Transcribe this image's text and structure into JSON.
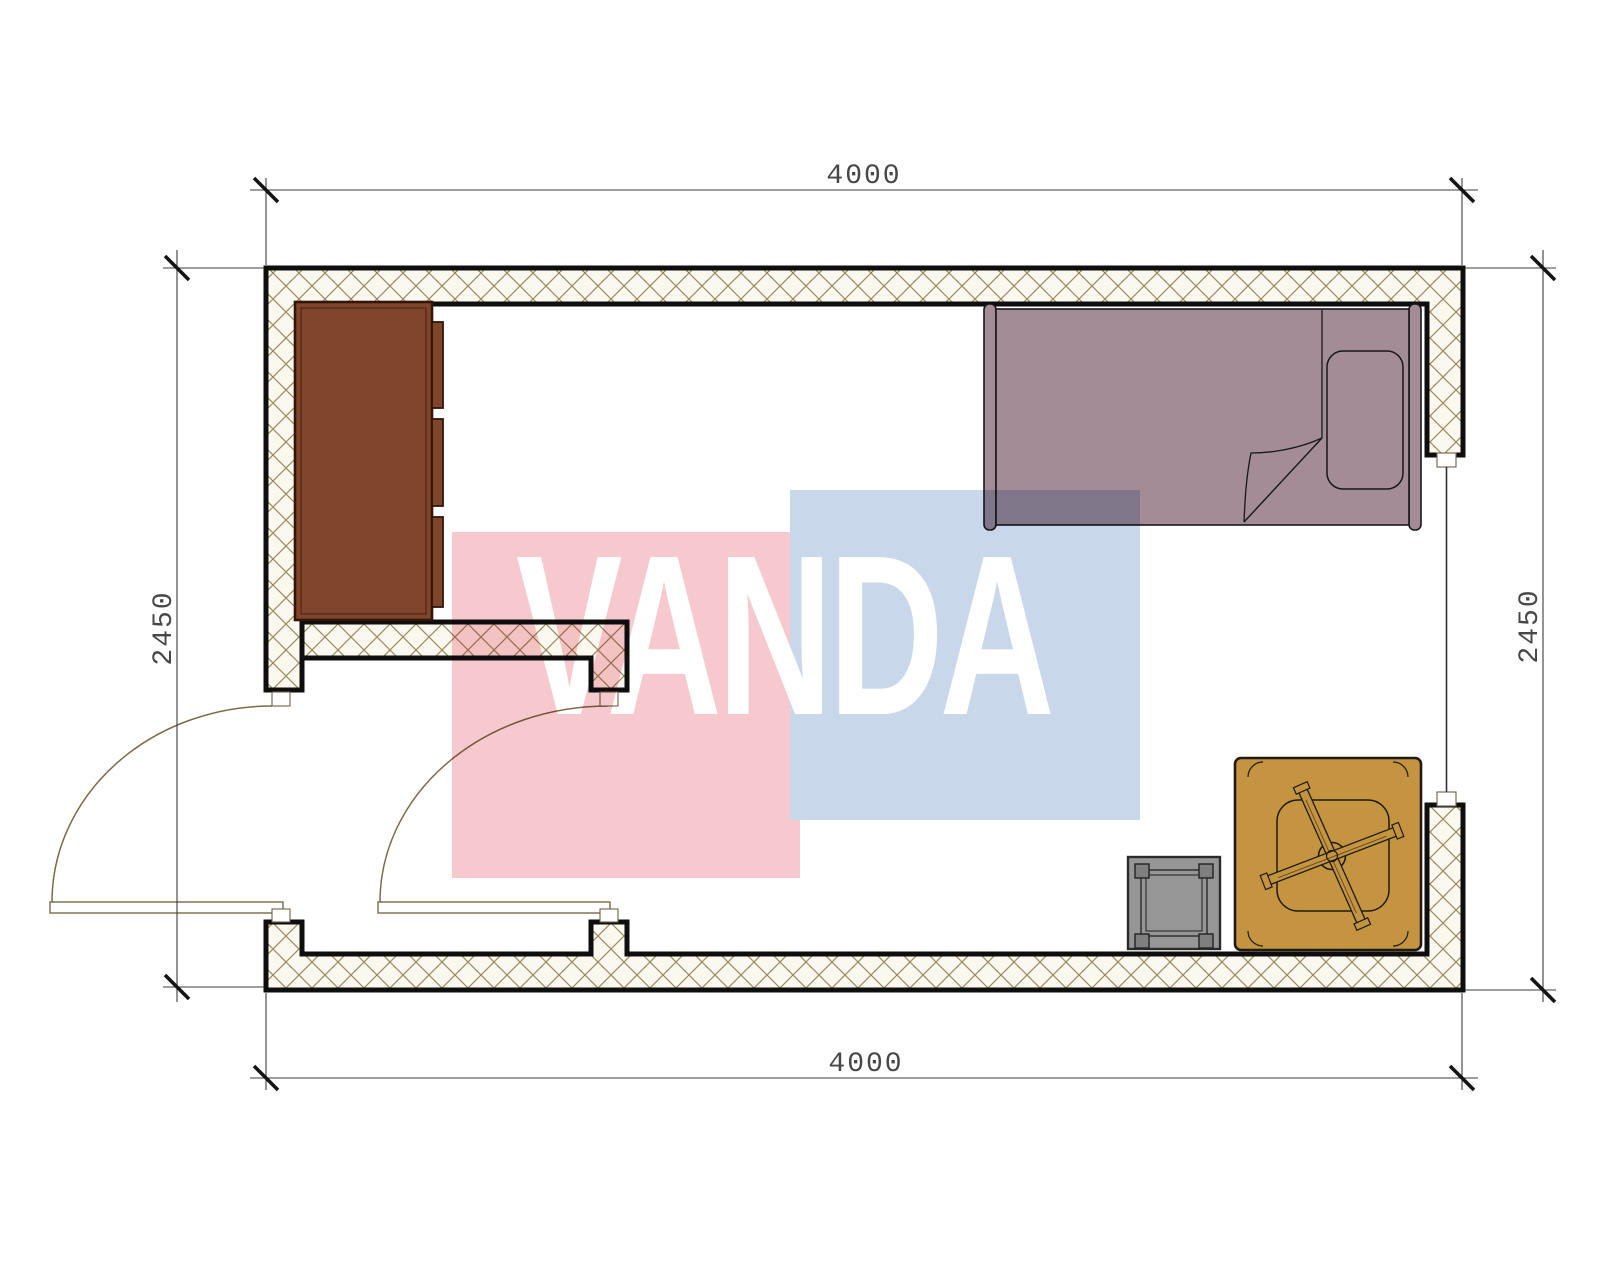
{
  "page": {
    "background": "#ffffff",
    "kind": "architectural floor plan drawing"
  },
  "plan": {
    "room": {
      "width_label": "4000",
      "depth_label": "2450",
      "units": "mm"
    },
    "dimensions": {
      "top": "4000",
      "bottom": "4000",
      "left": "2450",
      "right": "2450"
    },
    "walls": {
      "fill": "#fbf8ef",
      "hatch_line_color": "#9a8a60",
      "outline_color": "#0e0e0e"
    },
    "furniture": {
      "wardrobe": {
        "color": "#80462c",
        "label": "wardrobe cabinet with three door fronts"
      },
      "bed": {
        "color": "#a38c96",
        "label": "single bed with pillow and folded blanket"
      },
      "table": {
        "color": "#c49441",
        "label": "square table with x-shaped leg base"
      },
      "stool": {
        "color": "#969696",
        "leg_color": "#7f7f7f",
        "label": "square stool"
      }
    },
    "doors": {
      "line_color": "#7c6a47",
      "count": 2
    },
    "window": {
      "line_color": "#2f2f3f",
      "location": "right wall"
    },
    "dimension_style": {
      "line_color": "#3c3c3c",
      "text_color": "#474747",
      "tick_color": "#151515"
    }
  },
  "watermark": {
    "text": "VANDA",
    "text_color": "#ffffff",
    "red_block_color": "#f6c9cf",
    "blue_block_color": "#c9d7ea"
  }
}
